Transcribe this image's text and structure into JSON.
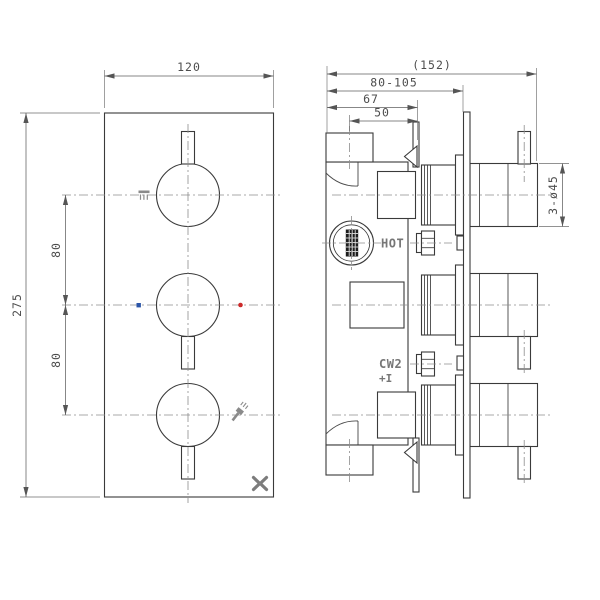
{
  "drawing": {
    "type": "technical-drawing-thermostatic-shower-valve-3-control",
    "background": "#ffffff",
    "line_color": "#3a3a3a",
    "dim_color": "#4d4d4d",
    "centerline_color": "#8d8d8d",
    "cold_indicator_color": "#2b55a8",
    "hot_indicator_color": "#cc2a2a",
    "logo_color": "#7c7c7c"
  },
  "front_view": {
    "dim_width": "120",
    "dim_height": "275",
    "dim_spacing_top": "80",
    "dim_spacing_bottom": "80",
    "icons": {
      "top_station": "overhead-shower-icon",
      "middle_station_left": "cold-indicator-dot",
      "middle_station_right": "hot-indicator-dot",
      "bottom_station": "hand-shower-icon",
      "corner": "brand-x-logo"
    }
  },
  "side_view": {
    "dim_overall": "(152)",
    "dim_adjust": "80-105",
    "dim_body": "67",
    "dim_port": "50",
    "dim_knob": "3-ø45",
    "label_hot": "HOT",
    "label_cw2": "CW2",
    "label_aux": "+I"
  }
}
